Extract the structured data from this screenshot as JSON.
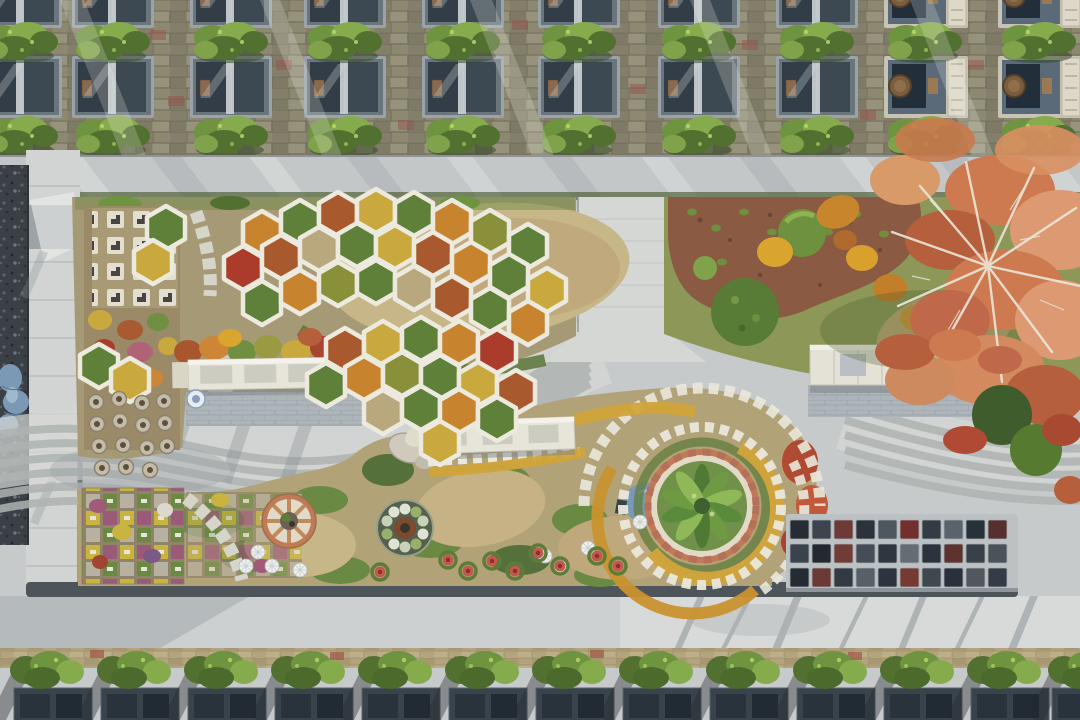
{
  "meta": {
    "title": "Aerial drone photograph of a landscaped memorial garden cemetery",
    "description": "Top-down view: upper and lower rows of grave plots with boxwood hedges, a central memorial garden with white honeycomb hexagon planters, winding striped S-curve pavement, circular spiral flower planter, terracotta wheel bed, white memorial benches, granite marker grid and a large autumn tree."
  },
  "palette": {
    "road": "#c7cacb",
    "roadLight": "#d9dcda",
    "stripe": "#aeb4b2",
    "stripeLight": "#d7d9d5",
    "paver": "#8d8971",
    "paverRed": "#96544a",
    "paverTan": "#b3a47e",
    "walkway": "#d2d4d3",
    "curb": "#4d555b",
    "gravel": "#3a4046",
    "slabFrame": "#9aa3aa",
    "slabDark": "#323d47",
    "slabMid": "#3d4952",
    "ornate": "#c8c4b4",
    "hedge": "#6f9440",
    "hedgeLight": "#86ab4c",
    "hedgeDark": "#527030",
    "dirt": "#b2a278",
    "straw": "#c7b688",
    "grass": "#6a8a44",
    "grassDark": "#55703a",
    "mulch": "#8a5a42",
    "hexFrame": "#eceade",
    "terracotta": "#c07a58",
    "cream": "#e0dac6",
    "benchWhite": "#e7e5da",
    "tarp": "#7b99b5",
    "autumn": "#cd7a50",
    "autumnLight": "#dd9a72",
    "autumnDeep": "#b55f3c",
    "branch": "#ece6d8",
    "marigold": "#d2a43a",
    "plaqueWhite": "#eae8dc",
    "graniteApron": "#bcc1c4"
  },
  "hexfills": [
    "#c8832f",
    "#a85a2e",
    "#5f8038",
    "#8a8f3a",
    "#ab3c2c",
    "#c9a93d",
    "#b9a87e",
    "#6f9a44",
    "#b06276",
    "#8a5a34"
  ],
  "granite": [
    "#262c33",
    "#3d444d",
    "#6e3a38",
    "#2a323a",
    "#4e565e",
    "#722f2d",
    "#333b44",
    "#5a636b",
    "#27313a",
    "#56302e",
    "#3a424b",
    "#24292f",
    "#703c36",
    "#454d56",
    "#2e363f",
    "#646c74",
    "#2b333c",
    "#5e332f",
    "#38404a",
    "#4a525a",
    "#252b32",
    "#6b3a34",
    "#323a43",
    "#575f67",
    "#2c343d",
    "#753a31",
    "#3f474f",
    "#29313a",
    "#52575e",
    "#343c45"
  ],
  "stamps": [
    {
      "target": "#hex-layer",
      "href": "#hex",
      "palette": "hexfills",
      "items": [
        [
          262,
          233,
          0
        ],
        [
          300,
          222,
          2
        ],
        [
          338,
          214,
          1
        ],
        [
          376,
          211,
          5
        ],
        [
          414,
          214,
          2
        ],
        [
          452,
          222,
          0
        ],
        [
          490,
          232,
          3
        ],
        [
          528,
          246,
          2
        ],
        [
          243,
          268,
          4
        ],
        [
          281,
          257,
          1
        ],
        [
          319,
          249,
          6
        ],
        [
          357,
          245,
          2
        ],
        [
          395,
          247,
          5
        ],
        [
          433,
          254,
          1
        ],
        [
          471,
          264,
          0
        ],
        [
          509,
          276,
          2
        ],
        [
          547,
          290,
          5
        ],
        [
          262,
          303,
          2
        ],
        [
          300,
          292,
          0
        ],
        [
          338,
          284,
          3
        ],
        [
          376,
          282,
          2
        ],
        [
          414,
          288,
          6
        ],
        [
          452,
          298,
          1
        ],
        [
          490,
          310,
          2
        ],
        [
          528,
          323,
          0
        ],
        [
          166,
          228,
          2
        ],
        [
          153,
          262,
          5
        ],
        [
          345,
          350,
          1
        ],
        [
          383,
          343,
          5
        ],
        [
          421,
          339,
          2
        ],
        [
          459,
          343,
          0
        ],
        [
          497,
          351,
          4
        ],
        [
          326,
          385,
          2
        ],
        [
          364,
          378,
          0
        ],
        [
          402,
          374,
          3
        ],
        [
          440,
          377,
          2
        ],
        [
          478,
          384,
          5
        ],
        [
          516,
          392,
          1
        ],
        [
          383,
          412,
          6
        ],
        [
          421,
          408,
          2
        ],
        [
          459,
          411,
          0
        ],
        [
          497,
          419,
          2
        ],
        [
          440,
          443,
          5
        ],
        [
          99,
          366,
          2
        ],
        [
          130,
          380,
          5
        ]
      ]
    },
    {
      "target": "#slab-layer",
      "href": "#slabA",
      "items": [
        [
          -20,
          -34
        ],
        [
          72,
          -34
        ],
        [
          190,
          -34
        ],
        [
          304,
          -34
        ],
        [
          422,
          -34
        ],
        [
          538,
          -34
        ],
        [
          658,
          -34
        ],
        [
          776,
          -34
        ],
        [
          -20,
          56
        ],
        [
          72,
          56
        ],
        [
          190,
          56
        ],
        [
          304,
          56
        ],
        [
          422,
          56
        ],
        [
          538,
          56
        ],
        [
          658,
          56
        ],
        [
          776,
          56
        ]
      ]
    },
    {
      "target": "#slab-layer",
      "href": "#slabB",
      "items": [
        [
          884,
          -34
        ],
        [
          998,
          -34
        ],
        [
          884,
          56
        ],
        [
          998,
          56
        ]
      ]
    },
    {
      "target": "#hedge-layer",
      "href": "#hedgeT",
      "items": [
        [
          -18,
          20
        ],
        [
          74,
          20
        ],
        [
          192,
          20
        ],
        [
          306,
          20
        ],
        [
          424,
          20
        ],
        [
          540,
          20
        ],
        [
          660,
          20
        ],
        [
          778,
          20
        ],
        [
          886,
          20
        ],
        [
          1000,
          20
        ],
        [
          -18,
          114
        ],
        [
          74,
          114
        ],
        [
          192,
          114
        ],
        [
          306,
          114
        ],
        [
          424,
          114
        ],
        [
          540,
          114
        ],
        [
          660,
          114
        ],
        [
          778,
          114
        ],
        [
          886,
          114
        ],
        [
          1000,
          114
        ]
      ]
    },
    {
      "target": "#bottom-plots",
      "href": "#bplot",
      "items": [
        [
          12,
          650
        ],
        [
          99,
          650
        ],
        [
          186,
          650
        ],
        [
          273,
          650
        ],
        [
          360,
          650
        ],
        [
          447,
          650
        ],
        [
          534,
          650
        ],
        [
          621,
          650
        ],
        [
          708,
          650
        ],
        [
          795,
          650
        ],
        [
          882,
          650
        ],
        [
          969,
          650
        ],
        [
          1050,
          650
        ]
      ]
    },
    {
      "target": "#pot-layer",
      "href": "#pot",
      "items": [
        [
          96,
          402
        ],
        [
          119,
          399
        ],
        [
          142,
          403
        ],
        [
          164,
          401
        ],
        [
          97,
          424
        ],
        [
          120,
          421
        ],
        [
          143,
          425
        ],
        [
          165,
          423
        ],
        [
          99,
          446
        ],
        [
          123,
          445
        ],
        [
          147,
          448
        ],
        [
          167,
          446
        ],
        [
          102,
          468
        ],
        [
          126,
          467
        ],
        [
          150,
          470
        ]
      ]
    },
    {
      "target": "#umb-layer",
      "href": "#umb",
      "items": [
        [
          258,
          552,
          1
        ],
        [
          272,
          566,
          0.8
        ],
        [
          246,
          566,
          0.7
        ],
        [
          545,
          556,
          1
        ],
        [
          562,
          568,
          0.85
        ],
        [
          588,
          548,
          0.7
        ],
        [
          640,
          522,
          0.7
        ],
        [
          300,
          570,
          0.7
        ]
      ]
    },
    {
      "target": "#fpot-layer",
      "href": "#fpot",
      "items": [
        [
          448,
          560
        ],
        [
          468,
          571
        ],
        [
          492,
          561
        ],
        [
          515,
          571
        ],
        [
          538,
          553
        ],
        [
          560,
          566
        ],
        [
          597,
          556
        ],
        [
          618,
          566
        ],
        [
          380,
          572
        ]
      ]
    },
    {
      "target": "#granite-grid",
      "href": "#gcell",
      "palette": "granite",
      "grid": {
        "x0": 790,
        "y0": 520,
        "dx": 22,
        "dy": 24,
        "cols": 10,
        "rows": 3
      }
    }
  ]
}
